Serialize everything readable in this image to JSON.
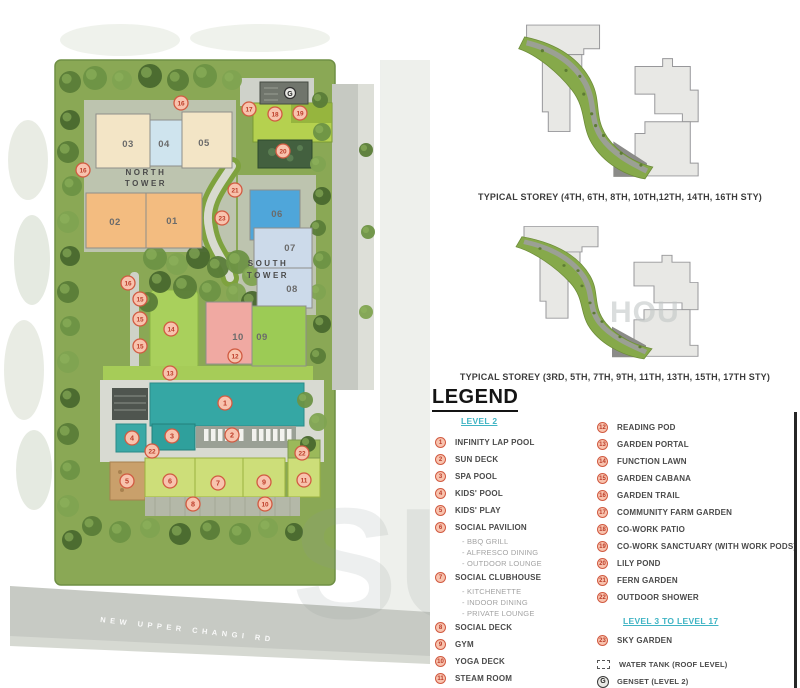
{
  "colors": {
    "marker_fill": "#f8c3ae",
    "marker_stroke": "#d15a41",
    "marker_number": "#bc3c28",
    "section_header_teal": "#3fb4c4",
    "pool_teal": "#35a7a4",
    "unit_orange": "#f3bc80",
    "unit_cream": "#f3e5c6",
    "unit_blue": "#4fa6da",
    "unit_greyblue": "#ccdaea",
    "unit_pink": "#f0a9a2",
    "unit_green": "#9ccb55"
  },
  "plan": {
    "north_tower_label_line1": "NORTH",
    "north_tower_label_line2": "TOWER",
    "south_tower_label_line1": "SOUTH",
    "south_tower_label_line2": "TOWER",
    "road_label": "NEW UPPER CHANGI RD",
    "genset_label": "G",
    "units": [
      {
        "no": "03",
        "x": 96,
        "y": 114,
        "w": 54,
        "h": 54,
        "color": "#f3e5c6",
        "lx": 128,
        "ly": 147
      },
      {
        "no": "04",
        "x": 150,
        "y": 120,
        "w": 32,
        "h": 46,
        "color": "#cfe4ee",
        "lx": 164,
        "ly": 147
      },
      {
        "no": "05",
        "x": 182,
        "y": 112,
        "w": 50,
        "h": 56,
        "color": "#f3e5c6",
        "lx": 204,
        "ly": 146
      },
      {
        "no": "02",
        "x": 86,
        "y": 193,
        "w": 60,
        "h": 55,
        "color": "#f3bc80",
        "lx": 115,
        "ly": 225
      },
      {
        "no": "01",
        "x": 146,
        "y": 193,
        "w": 56,
        "h": 55,
        "color": "#f3bc80",
        "lx": 172,
        "ly": 224
      },
      {
        "no": "06",
        "x": 250,
        "y": 190,
        "w": 50,
        "h": 50,
        "color": "#4fa6da",
        "lx": 277,
        "ly": 217
      },
      {
        "no": "07",
        "x": 254,
        "y": 228,
        "w": 58,
        "h": 40,
        "color": "#ccdaea",
        "lx": 290,
        "ly": 251
      },
      {
        "no": "08",
        "x": 257,
        "y": 268,
        "w": 55,
        "h": 40,
        "color": "#ccdaea",
        "lx": 292,
        "ly": 292
      },
      {
        "no": "10",
        "x": 206,
        "y": 302,
        "w": 46,
        "h": 62,
        "color": "#f0a9a2",
        "lx": 238,
        "ly": 340
      },
      {
        "no": "09",
        "x": 252,
        "y": 306,
        "w": 54,
        "h": 60,
        "color": "#9ccb55",
        "lx": 262,
        "ly": 340
      }
    ],
    "markers": [
      {
        "n": "1",
        "x": 225,
        "y": 403
      },
      {
        "n": "2",
        "x": 232,
        "y": 435
      },
      {
        "n": "3",
        "x": 172,
        "y": 436
      },
      {
        "n": "4",
        "x": 132,
        "y": 438
      },
      {
        "n": "5",
        "x": 127,
        "y": 481
      },
      {
        "n": "6",
        "x": 170,
        "y": 481
      },
      {
        "n": "7",
        "x": 218,
        "y": 483
      },
      {
        "n": "8",
        "x": 193,
        "y": 504
      },
      {
        "n": "9",
        "x": 264,
        "y": 482
      },
      {
        "n": "10",
        "x": 265,
        "y": 504
      },
      {
        "n": "11",
        "x": 304,
        "y": 480
      },
      {
        "n": "12",
        "x": 235,
        "y": 356
      },
      {
        "n": "13",
        "x": 170,
        "y": 373
      },
      {
        "n": "14",
        "x": 171,
        "y": 329
      },
      {
        "n": "15",
        "x": 140,
        "y": 299
      },
      {
        "n": "15",
        "x": 140,
        "y": 319
      },
      {
        "n": "15",
        "x": 140,
        "y": 346
      },
      {
        "n": "16",
        "x": 83,
        "y": 170
      },
      {
        "n": "16",
        "x": 181,
        "y": 103
      },
      {
        "n": "16",
        "x": 128,
        "y": 283
      },
      {
        "n": "17",
        "x": 249,
        "y": 109
      },
      {
        "n": "18",
        "x": 275,
        "y": 114
      },
      {
        "n": "19",
        "x": 300,
        "y": 113
      },
      {
        "n": "20",
        "x": 283,
        "y": 151
      },
      {
        "n": "21",
        "x": 235,
        "y": 190
      },
      {
        "n": "22",
        "x": 152,
        "y": 451
      },
      {
        "n": "22",
        "x": 302,
        "y": 453
      },
      {
        "n": "23",
        "x": 222,
        "y": 218
      }
    ]
  },
  "storey_diagrams": [
    {
      "caption": "TYPICAL STOREY (4TH, 6TH, 8TH, 10TH,12TH, 14TH, 16TH STY)"
    },
    {
      "caption": "TYPICAL STOREY (3RD, 5TH, 7TH, 9TH, 11TH, 13TH, 15TH, 17TH STY)"
    }
  ],
  "legend": {
    "title": "LEGEND",
    "sections": [
      {
        "header": "LEVEL 2",
        "items": [
          {
            "n": "1",
            "label": "INFINITY LAP POOL"
          },
          {
            "n": "2",
            "label": "SUN DECK"
          },
          {
            "n": "3",
            "label": "SPA POOL"
          },
          {
            "n": "4",
            "label": "KIDS' POOL"
          },
          {
            "n": "5",
            "label": "KIDS' PLAY"
          },
          {
            "n": "6",
            "label": "SOCIAL PAVILION",
            "subs": [
              "BBQ GRILL",
              "ALFRESCO DINING",
              "OUTDOOR LOUNGE"
            ]
          },
          {
            "n": "7",
            "label": "SOCIAL CLUBHOUSE",
            "subs": [
              "KITCHENETTE",
              "INDOOR DINING",
              "PRIVATE LOUNGE"
            ]
          },
          {
            "n": "8",
            "label": "SOCIAL DECK"
          },
          {
            "n": "9",
            "label": "GYM"
          },
          {
            "n": "10",
            "label": "YOGA DECK"
          },
          {
            "n": "11",
            "label": "STEAM ROOM"
          },
          {
            "n": "12",
            "label": "READING POD"
          },
          {
            "n": "13",
            "label": "GARDEN PORTAL"
          },
          {
            "n": "14",
            "label": "FUNCTION LAWN"
          },
          {
            "n": "15",
            "label": "GARDEN CABANA"
          },
          {
            "n": "16",
            "label": "GARDEN TRAIL"
          },
          {
            "n": "17",
            "label": "COMMUNITY FARM GARDEN"
          },
          {
            "n": "18",
            "label": "CO-WORK PATIO"
          },
          {
            "n": "19",
            "label": "CO-WORK SANCTUARY (WITH WORK PODS)"
          },
          {
            "n": "20",
            "label": "LILY POND"
          },
          {
            "n": "21",
            "label": "FERN GARDEN"
          },
          {
            "n": "22",
            "label": "OUTDOOR SHOWER"
          }
        ]
      },
      {
        "header": "LEVEL 3 TO LEVEL 17",
        "items": [
          {
            "n": "23",
            "label": "SKY GARDEN"
          }
        ]
      }
    ],
    "symbols": [
      {
        "icon": "water-tank-icon",
        "label": "WATER TANK (ROOF LEVEL)"
      },
      {
        "icon": "genset-icon",
        "label": "GENSET (LEVEL 2)"
      }
    ]
  },
  "watermarks": {
    "map": "SU",
    "right": "HOU"
  }
}
